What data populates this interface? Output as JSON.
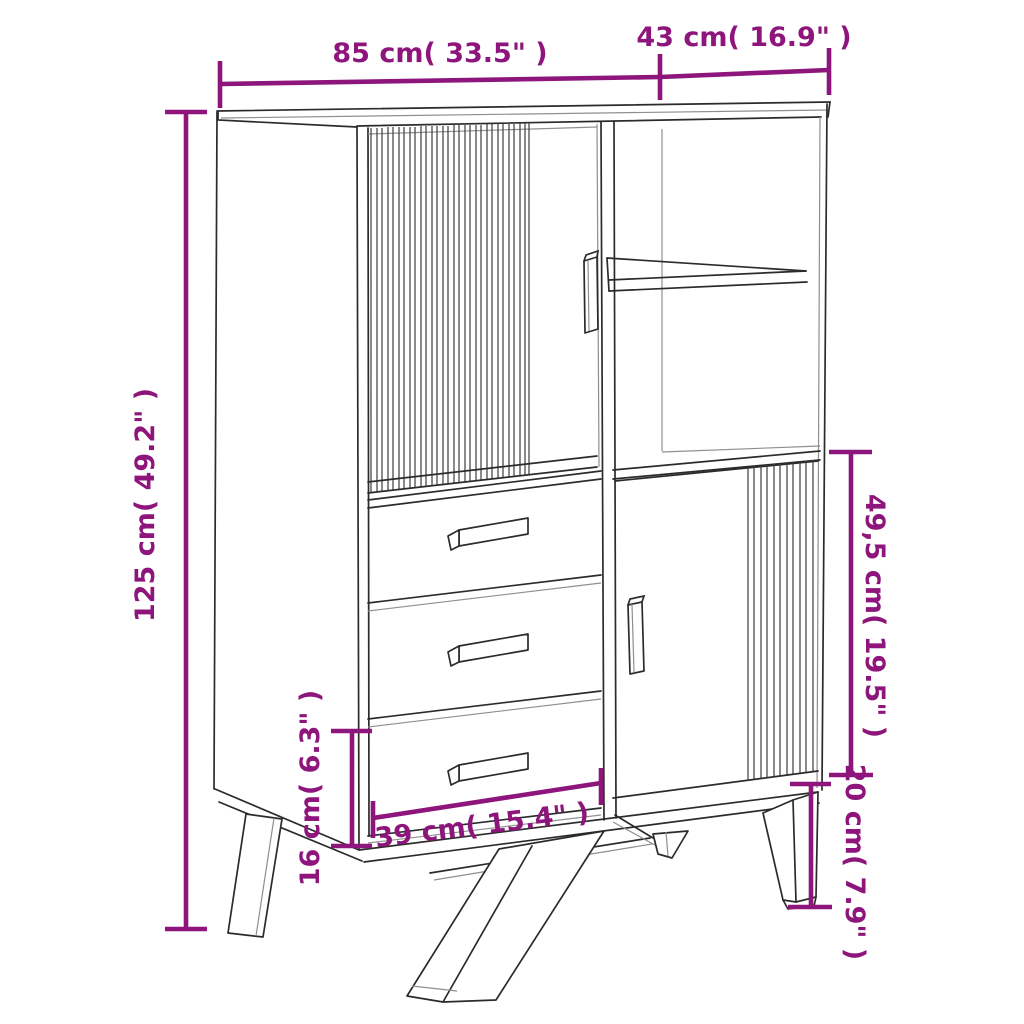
{
  "diagram": {
    "kind": "furniture dimension diagram",
    "subject": "highboard cabinet with slatted sliding doors, open shelf, three drawers and angled legs"
  },
  "colors": {
    "dimension_accent": "#8D157B",
    "drawing_line": "#2b2b2b",
    "background": "#ffffff"
  },
  "labels": {
    "width": "85 cm( 33.5\" )",
    "depth": "43 cm( 16.9\" )",
    "height": "125 cm( 49.2\" )",
    "door_section_height": "49,5 cm( 19.5\" )",
    "drawer_width": "39 cm( 15.4\" )",
    "bottom_drawer_height": "16 cm( 6.3\" )",
    "leg_height": "20 cm( 7.9\" )"
  }
}
